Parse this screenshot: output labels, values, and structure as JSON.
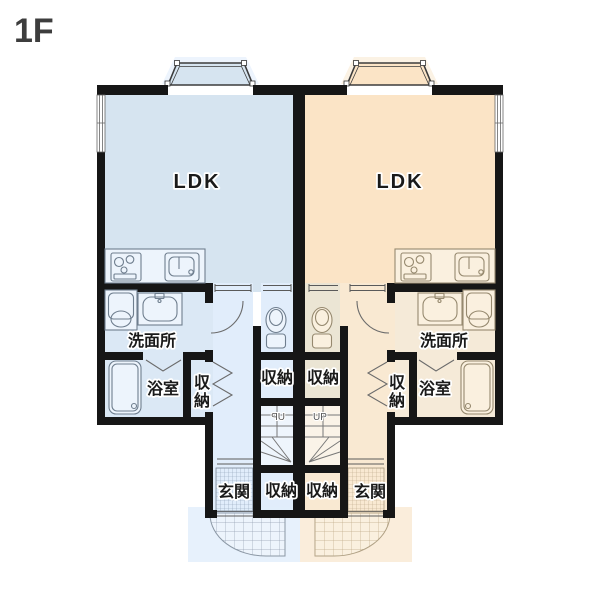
{
  "floor_label": "1F",
  "units": {
    "left": {
      "ldk": "LDK",
      "washroom": "洗面所",
      "bathroom": "浴室",
      "closet_side": [
        "収",
        "納"
      ],
      "closet_hall": "収納",
      "closet_entrance": "収納",
      "entrance": "玄関",
      "stairs": "UP"
    },
    "right": {
      "ldk": "LDK",
      "washroom": "洗面所",
      "bathroom": "浴室",
      "closet_side": [
        "収",
        "納"
      ],
      "closet_hall": "収納",
      "closet_entrance": "収納",
      "entrance": "玄関",
      "stairs": "UP"
    }
  },
  "colors": {
    "unit-left-main": "#d6e4f0",
    "unit-left-soft": "#dbe8f5",
    "unit-left-light": "#e1edfb",
    "unit-left-pale": "#eef5fc",
    "unit-left-fixture": "#edf4fc",
    "unit-left-outline": "#6f7e8e",
    "unit-right-main": "#fbe4c6",
    "unit-right-soft": "#f5ead8",
    "unit-right-light": "#f9e9d2",
    "unit-right-muted": "#ebe5d4",
    "unit-right-pale": "#faf3e8",
    "unit-right-fixture": "#faf0df",
    "unit-right-outline": "#96896f",
    "wall": "#161616",
    "thin-line": "#5a5a5a",
    "label-text": "#1a1a1a",
    "floor-label": "#3d3d3d"
  }
}
